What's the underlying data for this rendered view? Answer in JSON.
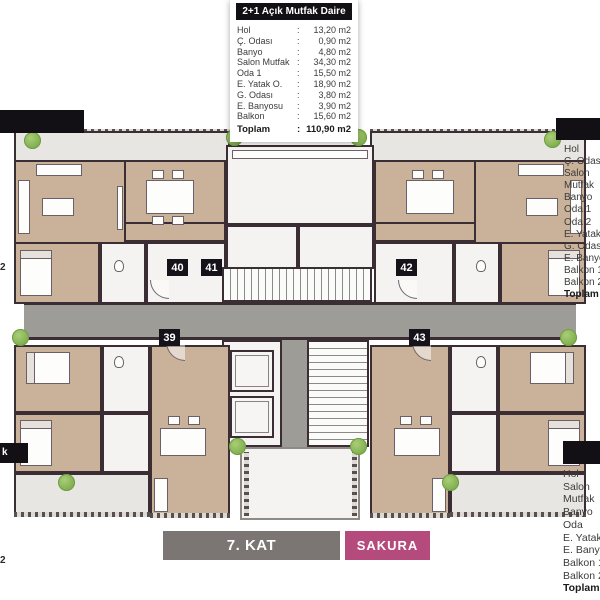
{
  "colon": ":",
  "unit_badges": [
    "39",
    "40",
    "41",
    "42",
    "43"
  ],
  "top_legend": {
    "title": "2+1 Açık Mutfak Daire",
    "rows": [
      {
        "label": "Hol",
        "value": "13,20 m2"
      },
      {
        "label": "Ç. Odası",
        "value": "0,90 m2"
      },
      {
        "label": "Banyo",
        "value": "4,80 m2"
      },
      {
        "label": "Salon Mutfak",
        "value": "34,30 m2"
      },
      {
        "label": "Oda 1",
        "value": "15,50 m2"
      },
      {
        "label": "E. Yatak O.",
        "value": "18,90 m2"
      },
      {
        "label": "G. Odası",
        "value": "3,80 m2"
      },
      {
        "label": "E. Banyosu",
        "value": "3,90 m2"
      },
      {
        "label": "Balkon",
        "value": "15,60 m2"
      }
    ],
    "total_label": "Toplam",
    "total_value": "110,90 m2"
  },
  "right_top_legend": {
    "items": [
      "Hol",
      "Ç. Odası",
      "Salon",
      "Mutfak",
      "Banyo",
      "Oda 1",
      "Oda 2",
      "E. Yatak O.",
      "G. Odası",
      "E. Banyosu",
      "Balkon 1",
      "Balkon 2"
    ],
    "total_label": "Toplam"
  },
  "right_bottom_legend": {
    "items": [
      "Hol",
      "Salon",
      "Mutfak",
      "Banyo",
      "Oda",
      "E. Yatak O.",
      "E. Banyosu",
      "Balkon 1",
      "Balkon 2"
    ],
    "total_label": "Toplam"
  },
  "left_fragments": {
    "cut_label_tail": "k",
    "m2_fragment_top": "2",
    "m2_fragment_bottom": "2"
  },
  "footer": {
    "floor_label": "7. KAT",
    "project_label": "SAKURA"
  },
  "colors": {
    "wall": "#3a2d33",
    "wood_floor": "#c9b299",
    "corridor": "#9d9c97",
    "accent_pink": "#b54a7c",
    "footer_gray": "#7b7573",
    "legend_black": "#121015",
    "tree_green": "#7fae4d"
  }
}
